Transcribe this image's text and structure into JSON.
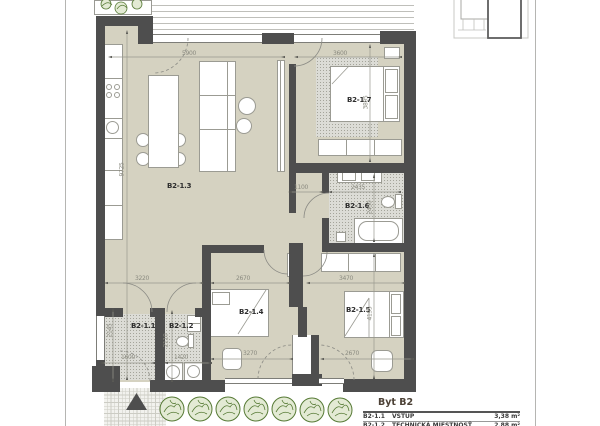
{
  "document": {
    "type": "apartment floor plan"
  },
  "rooms": {
    "living": "B2-1.3",
    "bedroom_top": "B2-1.7",
    "bathroom": "B2-1.6",
    "entry": "B2-1.1",
    "technical": "B2-1.2",
    "bedroom_mid": "B2-1.4",
    "bedroom_right": "B2-1.5"
  },
  "dims": {
    "living_width": "5900",
    "bedroom_top_width": "3600",
    "plan_height": "9725",
    "bedroom_top_height": "3805",
    "corridor_width": "1100",
    "bathroom_width": "2435",
    "bathroom_height": "2450",
    "living_bottom": "3220",
    "bedroom_mid_width": "2670",
    "bedroom_right_width": "3470",
    "bedroom_right_height": "4195",
    "entry_depth": "2145",
    "technical_depth": "2110",
    "entry_width": "1600",
    "technical_width": "1420",
    "bedroom_mid_bottom": "3270",
    "bedroom_right_bottom": "2670"
  },
  "legend": {
    "title": "Byt B2",
    "rows": [
      {
        "code": "B2-1.1",
        "name": "VSTUP",
        "area": "3,38 m²"
      },
      {
        "code": "B2-1.2",
        "name": "TECHNICKÁ MIESTNOSŤ",
        "area": "2,88 m²"
      }
    ]
  },
  "colors": {
    "floor": "#d5d2c1",
    "wall": "#4e4e4e",
    "stipple": "#dcdcd6",
    "greenery": "#567a35",
    "legend_title": "#4c4136"
  }
}
